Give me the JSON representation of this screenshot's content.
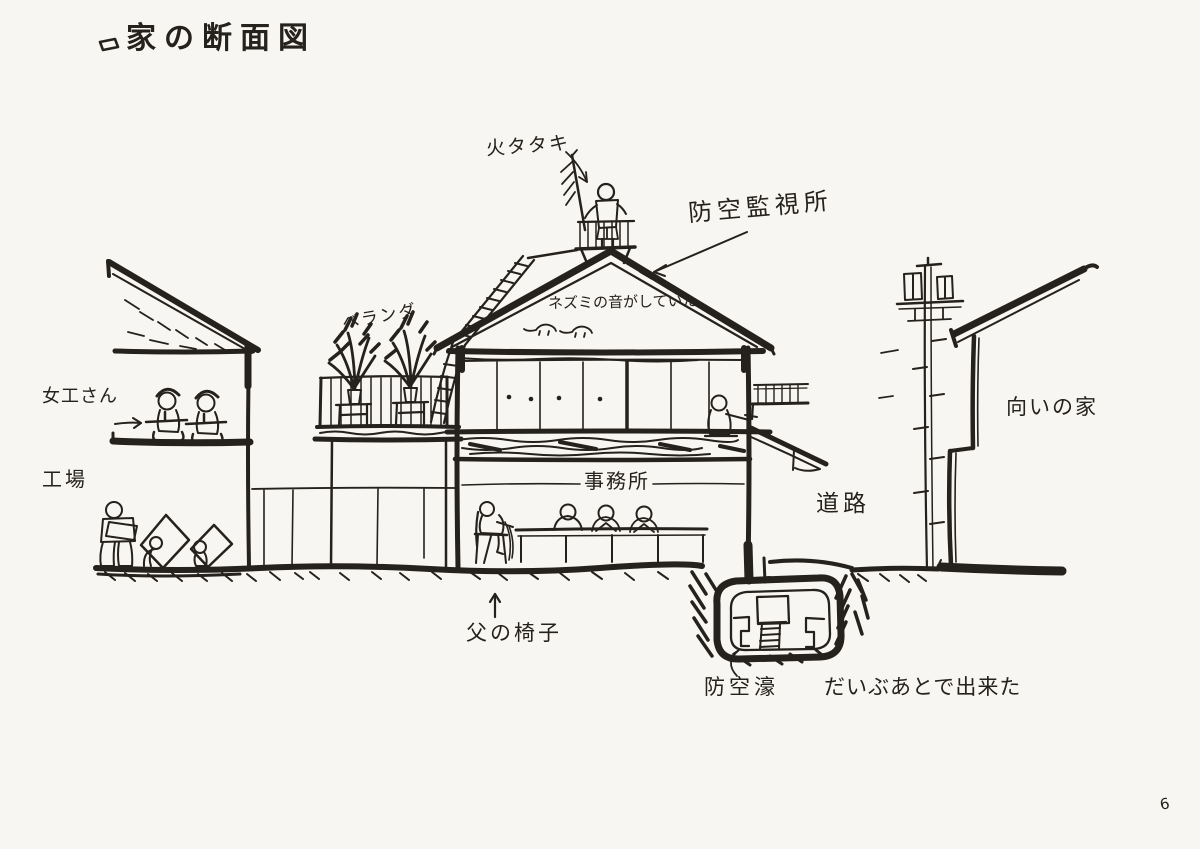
{
  "page": {
    "page_number": "6",
    "paper_color": "#f8f6f2",
    "ink_color": "#25211d"
  },
  "title": {
    "text": "家の断面図"
  },
  "labels": {
    "fire_beater": "火タタキ",
    "air_watch_station": "防空監視所",
    "mice_sound": "ネズミの音がしていた",
    "veranda": "ベランダ",
    "factory_women": "女工さん",
    "factory": "工場",
    "office": "事務所",
    "road": "道路",
    "opposite_house": "向いの家",
    "fathers_chair": "父の椅子",
    "air_raid_shelter": "防空濠",
    "shelter_note": "だいぶあとで出来た"
  }
}
